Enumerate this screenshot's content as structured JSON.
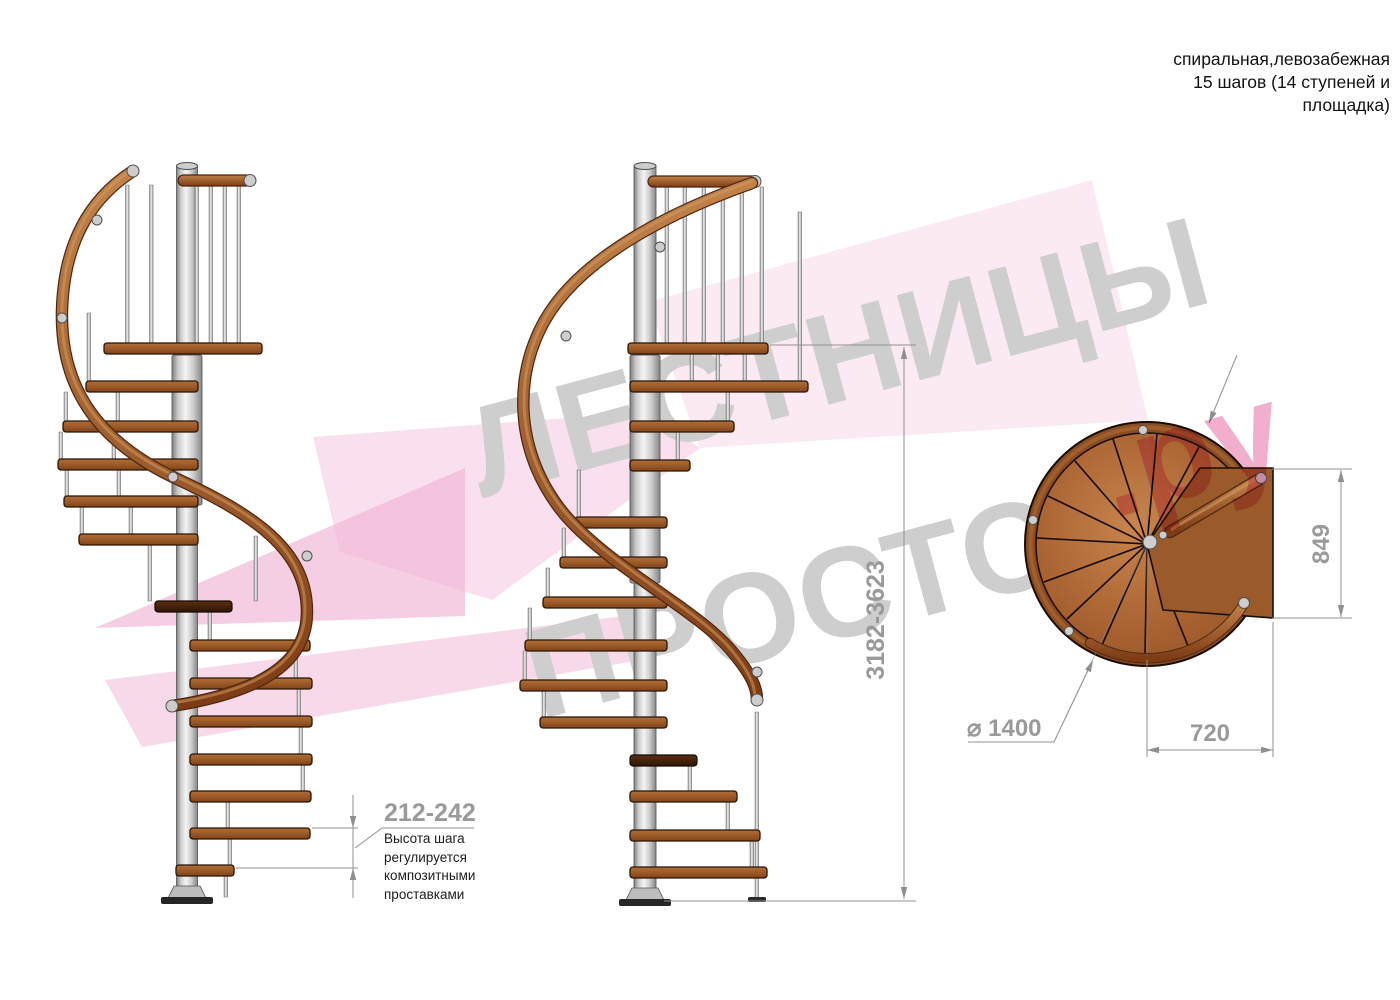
{
  "header": {
    "title": "спиральная,левозабежная\n15 шагов (14 ступеней и\nплощадка)"
  },
  "watermark": {
    "word1": "ЛЕСТНИЦЫ",
    "word2": "ПРОСТО",
    "word3": ".ру"
  },
  "dimensions": {
    "step_height": {
      "value": "212-242",
      "note": "Высота шага\nрегулируется\nкомпозитными\nпроставками"
    },
    "total_height": {
      "value": "3182-3623"
    },
    "plan_width": {
      "value": "849"
    },
    "plan_depth": {
      "value": "720"
    },
    "plan_diameter": {
      "value": "⌀ 1400"
    }
  },
  "colors": {
    "wood": "#a0622d",
    "handrail": "#a35a28",
    "metal": "#d9d9d9",
    "dimension_gray": "#9a9a9a",
    "text_black": "#1c1c1c",
    "watermark_gray": "#cecece",
    "watermark_pink": "#f2aecd"
  }
}
